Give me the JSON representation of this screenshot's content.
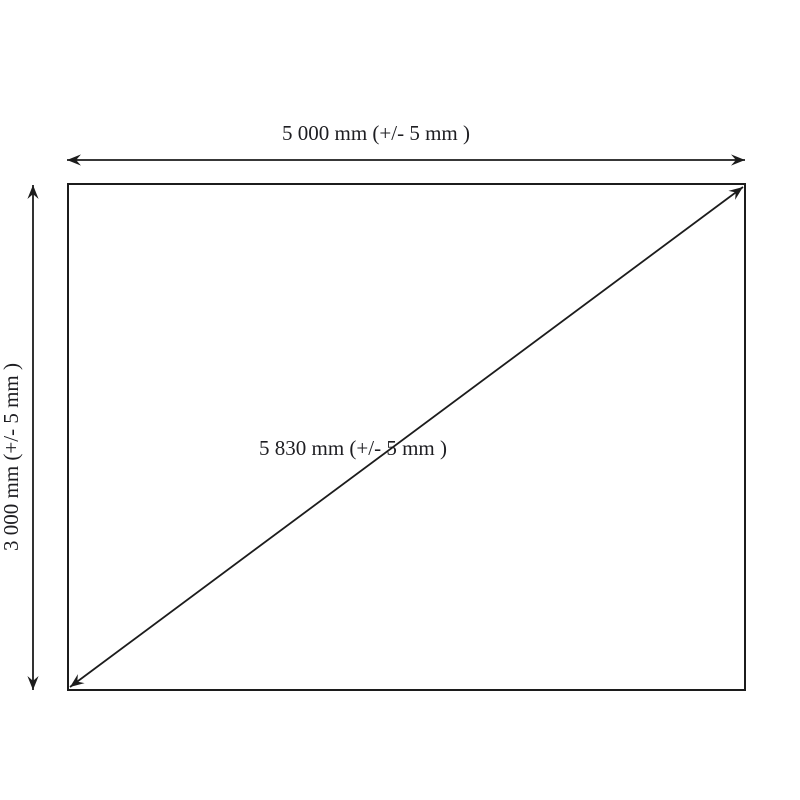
{
  "colors": {
    "background": "#ffffff",
    "line": "#1c1c1c",
    "text": "#1e1e22"
  },
  "diagram": {
    "type": "dimensioned-rectangle-drawing",
    "width_label": "5 000 mm (+/- 5 mm )",
    "height_label": "3 000 mm (+/- 5 mm )",
    "diagonal_label": "5 830 mm (+/- 5 mm )",
    "width_value_mm": 5000,
    "height_value_mm": 3000,
    "diagonal_value_mm": 5830,
    "tolerance": "+/- 5 mm"
  }
}
